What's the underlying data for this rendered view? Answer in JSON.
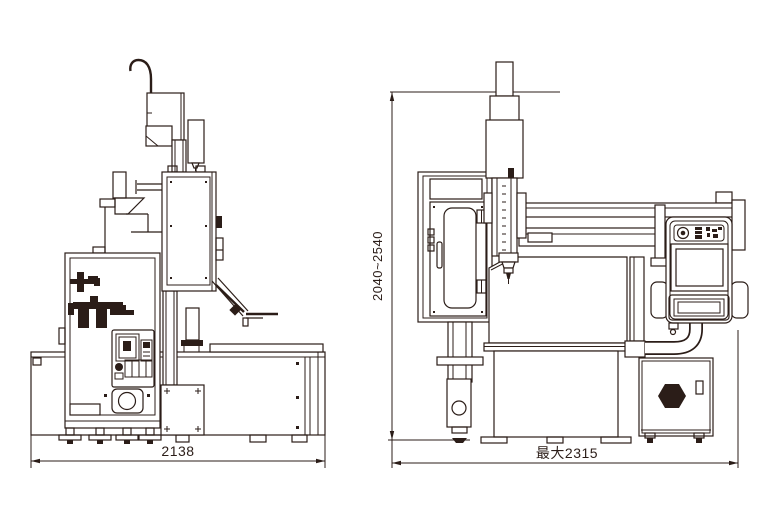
{
  "colors": {
    "background": "#ffffff",
    "line": "#2b1d18"
  },
  "drawing": {
    "description_left_view": "front elevation of machine",
    "description_right_view": "side elevation of machine with pendant",
    "left_view": {
      "width_dim_label": "2138"
    },
    "right_view": {
      "width_dim_label": "最大2315",
      "height_dim_label": "2040~2540"
    }
  }
}
